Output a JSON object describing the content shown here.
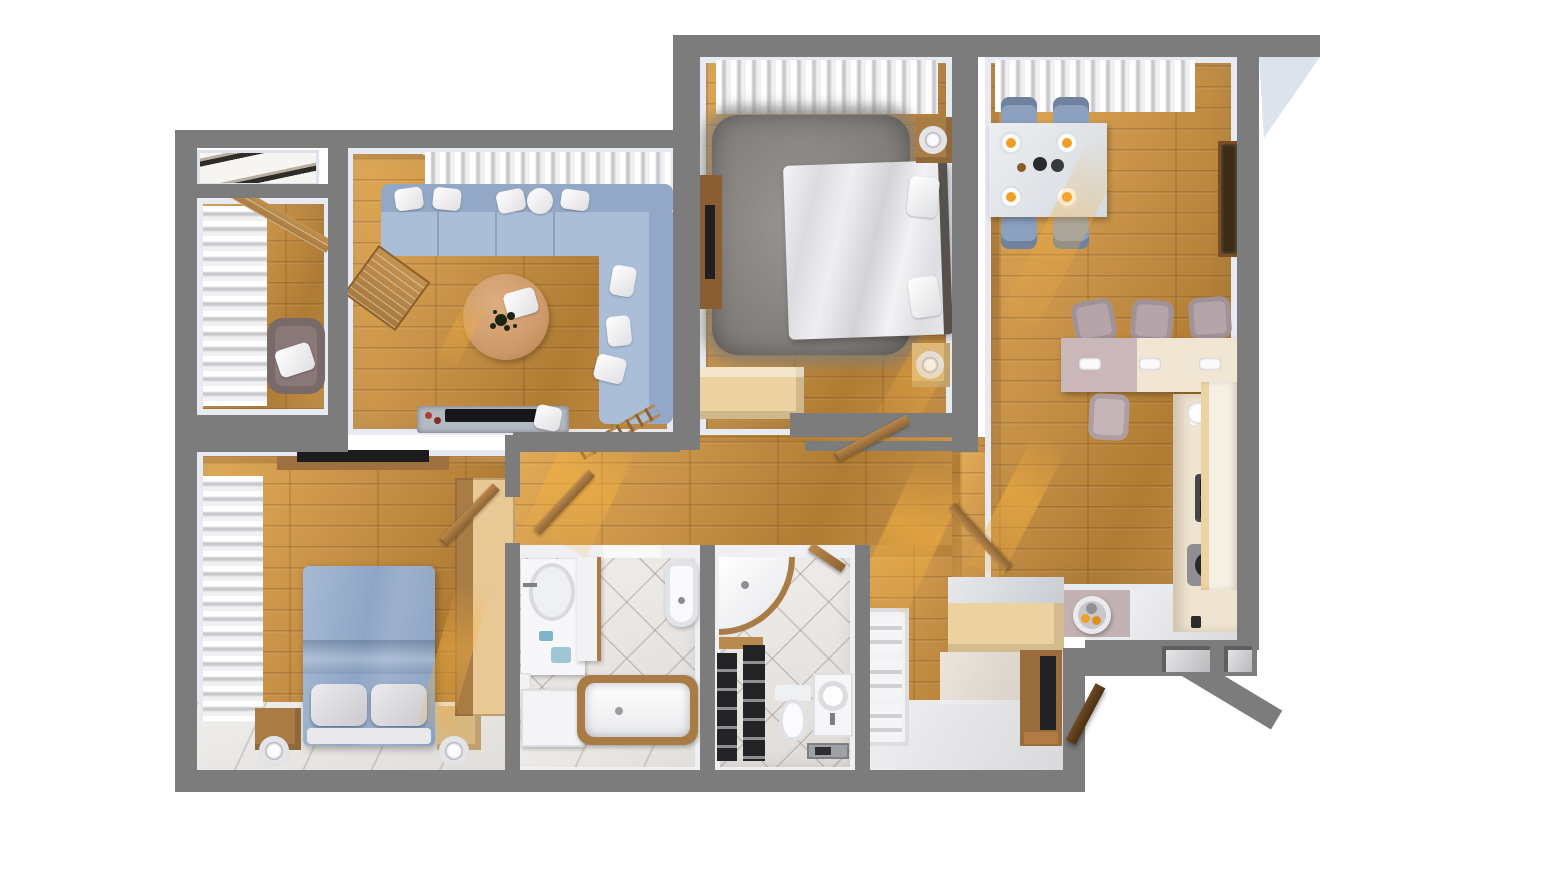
{
  "scene": {
    "title": "Top-down 3D render of an apartment floor plan",
    "view": "bird's-eye cutaway, no visible text labels",
    "background": "#ffffff"
  },
  "palette": {
    "wall": "#7c7c7c",
    "lining": "#e7eaf1",
    "wood": "#c99349",
    "woodDark": "#b07c34",
    "woodLight": "#e2ab57",
    "sofa": "#abbed8",
    "sofaBack": "#93a8c6",
    "rug": "#8f8b88",
    "duvet": "#ededf0",
    "bedBlue": "#9cb2ce",
    "pillowGray": "#d9d9dd",
    "beige": "#ecd2a0",
    "cream": "#f0e6d3",
    "counter": "#eee4d1",
    "brown": "#a97c46",
    "woodItem": "#b8894d",
    "mauve": "#c9b7b9",
    "matMauve": "#c3b2b3",
    "armchair": "#8b7878",
    "stool": "#b5a5aa",
    "chairBlue": "#8ca1c0",
    "dark": "#232326",
    "glass": "#b4bac2",
    "offWhite": "#f4f4f6",
    "tableTan": "#cf9a6b",
    "frameBrown": "#7a4e22",
    "orange": "#f0a026",
    "exterior": "#dde3ec",
    "blackShelf": "#242426",
    "sun": "#f6b240"
  },
  "rooms": [
    {
      "id": "built-in-closet",
      "contents": [
        "folded sliding doors"
      ]
    },
    {
      "id": "study-loggia",
      "contents": [
        "window curtains",
        "wall shelf",
        "armchair with pillow"
      ]
    },
    {
      "id": "living-room",
      "contents": [
        "window curtains",
        "corner sofa with pillows",
        "round coffee table with plant and pillow",
        "easel shelf",
        "tv stand with tv"
      ]
    },
    {
      "id": "master-bedroom",
      "contents": [
        "window curtains",
        "shag rug",
        "double bed with white duvet",
        "two nightstands with lamps",
        "tv dresser",
        "storage bench"
      ]
    },
    {
      "id": "kitchen-dining",
      "contents": [
        "window curtains",
        "dining table with plates",
        "four dining chairs",
        "wall picture",
        "bar counter",
        "four bar stools",
        "kitchen counter with sink and hob",
        "flower vase",
        "fridge"
      ]
    },
    {
      "id": "bedroom-2",
      "contents": [
        "window curtains",
        "tv on wall shelf",
        "double bed with blue duvet",
        "two nightstands with lamps",
        "wardrobe",
        "open door leaf"
      ]
    },
    {
      "id": "bathroom",
      "contents": [
        "washbasin vanity",
        "tall cabinet",
        "bidet",
        "washer cabinet",
        "bathtub with wood rim"
      ]
    },
    {
      "id": "wc-shower-room",
      "contents": [
        "corner shower with wood rim",
        "black shelving unit",
        "toilet",
        "washbasin cabinet",
        "wood tray"
      ]
    },
    {
      "id": "hallway-entry",
      "contents": [
        "ladder",
        "open door leaves",
        "storage bench",
        "open wardrobe with pillow stacks",
        "wall console with mirror",
        "fruit side table",
        "entry door leaf",
        "wall niches"
      ]
    }
  ]
}
